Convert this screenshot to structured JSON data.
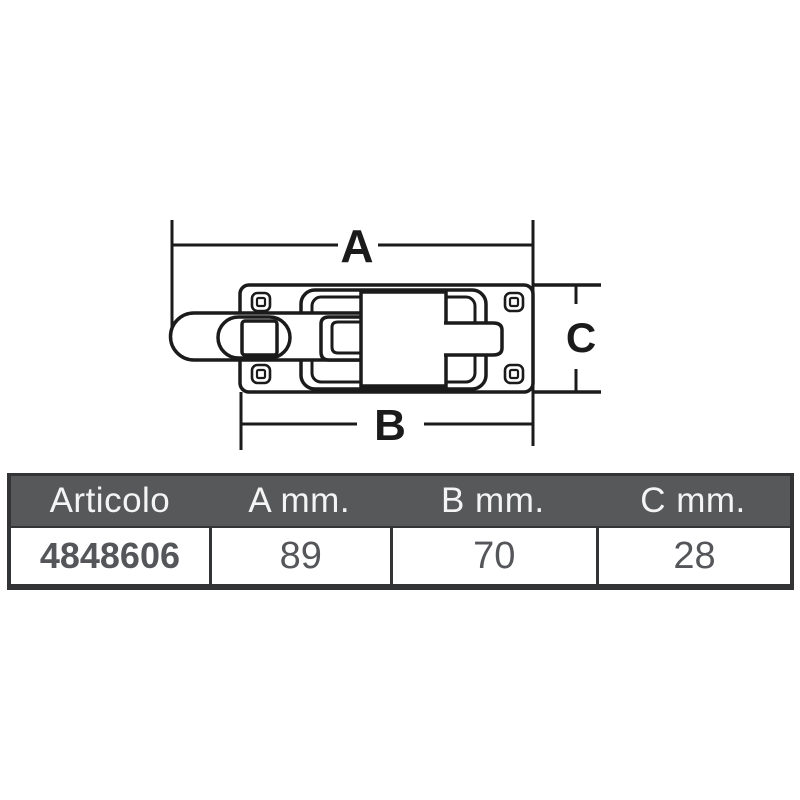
{
  "drawing": {
    "labels": {
      "a": "A",
      "b": "B",
      "c": "C"
    },
    "line_color": "#1b1b1b",
    "fill_color": "#ffffff"
  },
  "table": {
    "header_bg": "#57585a",
    "header_text_color": "#f4f4f4",
    "body_text_color": "#55565a",
    "border_color": "#333435",
    "columns": [
      "Articolo",
      "A mm.",
      "B mm.",
      "C mm."
    ],
    "rows": [
      [
        "4848606",
        "89",
        "70",
        "28"
      ]
    ]
  }
}
